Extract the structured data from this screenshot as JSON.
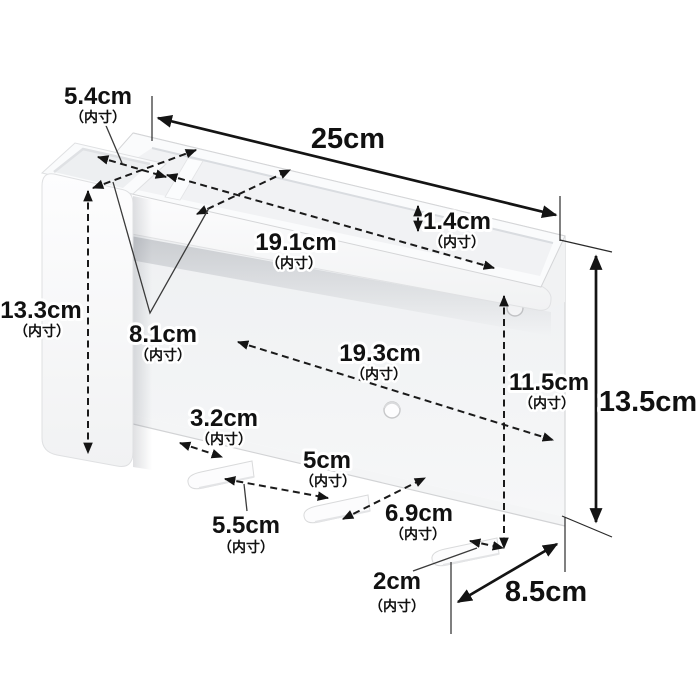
{
  "figure": {
    "type": "product-dimension-diagram",
    "background": "#ffffff",
    "product_color": "#f7f8f9",
    "annotation_color": "#1a1a1a",
    "hook_count": 3,
    "screw_hole_count": 2
  },
  "dims": [
    {
      "id": "overall-width",
      "value": "25cm",
      "note": ""
    },
    {
      "id": "left-pocket-depth",
      "value": "5.4cm",
      "note": "（内寸）"
    },
    {
      "id": "tray-inner-depth",
      "value": "8.1cm",
      "note": "（内寸）"
    },
    {
      "id": "tray-inner-width",
      "value": "19.1cm",
      "note": "（内寸）"
    },
    {
      "id": "tray-inner-height",
      "value": "1.4cm",
      "note": "（内寸）"
    },
    {
      "id": "left-pocket-inner-height",
      "value": "13.3cm",
      "note": "（内寸）"
    },
    {
      "id": "lower-inner-width",
      "value": "19.3cm",
      "note": "（内寸）"
    },
    {
      "id": "lower-inner-height",
      "value": "11.5cm",
      "note": "（内寸）"
    },
    {
      "id": "overall-height",
      "value": "13.5cm",
      "note": ""
    },
    {
      "id": "hook-gap-left",
      "value": "3.2cm",
      "note": "（内寸）"
    },
    {
      "id": "hook-gap-middle",
      "value": "5cm",
      "note": "（内寸）"
    },
    {
      "id": "hook-length",
      "value": "5.5cm",
      "note": "（内寸）"
    },
    {
      "id": "hook-gap-right",
      "value": "6.9cm",
      "note": "（内寸）"
    },
    {
      "id": "hook-width",
      "value": "2cm",
      "note": "（内寸）"
    },
    {
      "id": "overall-depth",
      "value": "8.5cm",
      "note": ""
    }
  ]
}
